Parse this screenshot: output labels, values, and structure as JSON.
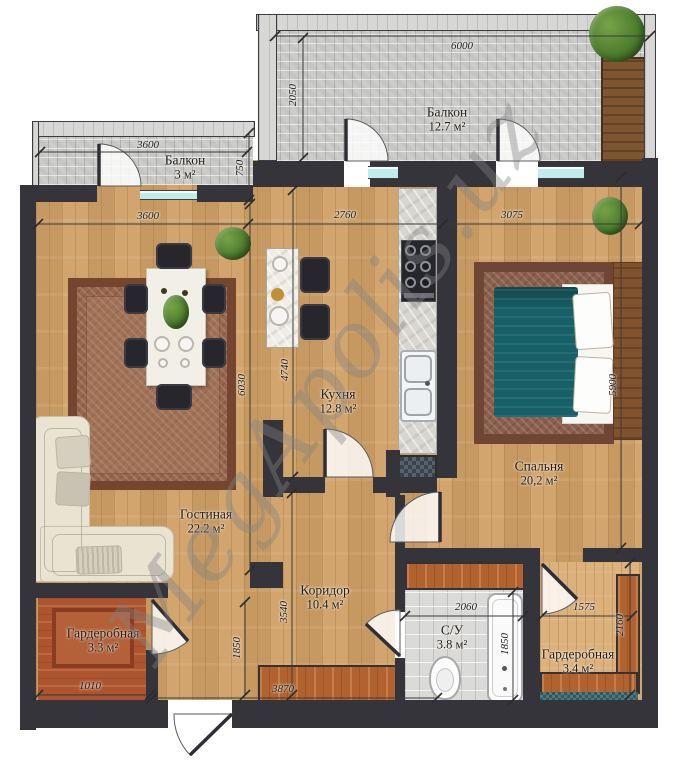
{
  "watermark": "MegApolis.uz",
  "rooms": {
    "balcony_top": {
      "name": "Балкон",
      "area": "12.7 м²"
    },
    "balcony_left": {
      "name": "Балкон",
      "area": "3 м²"
    },
    "kitchen": {
      "name": "Кухня",
      "area": "12.8 м²"
    },
    "bedroom": {
      "name": "Спальня",
      "area": "20,2 м²"
    },
    "living": {
      "name": "Гостиная",
      "area": "22.2 м²"
    },
    "corridor": {
      "name": "Коридор",
      "area": "10.4 м²"
    },
    "bathroom": {
      "name": "С/У",
      "area": "3.8 м²"
    },
    "wardrobe_left": {
      "name": "Гардеробная",
      "area": "3.3 м²"
    },
    "wardrobe_right": {
      "name": "Гардеробная",
      "area": "3.4 м²"
    }
  },
  "dims": {
    "balcony_top_width": "6000",
    "balcony_top_depth": "2050",
    "balcony_left_width": "3600",
    "balcony_left_depth": "750",
    "living_width": "3600",
    "kitchen_width": "2760",
    "bedroom_width": "3075",
    "living_height": "6030",
    "kitchen_height": "4740",
    "bedroom_height": "5900",
    "corridor_height": "3540",
    "hall_height": "1850",
    "bathroom_width": "2060",
    "bathroom_height": "1850",
    "wardrobe_right_width": "1575",
    "wardrobe_right_height": "2160",
    "wardrobe_left_width": "1010",
    "corridor_width": "3870"
  },
  "colors": {
    "wall": "#34343a",
    "wood_floor": "#d0a066",
    "paver": "#cccccb",
    "window_glass": "#c2ebec",
    "bed_blanket": "#176067",
    "terracotta": "#ad5530",
    "cabinet_wood": "#b2622f",
    "rug_living": "#96664d",
    "rug_bedroom": "#8a5f4e",
    "sofa": "#e9e3d2",
    "plant_green": "#4a7a2c",
    "watermark_gray": "#828284"
  }
}
